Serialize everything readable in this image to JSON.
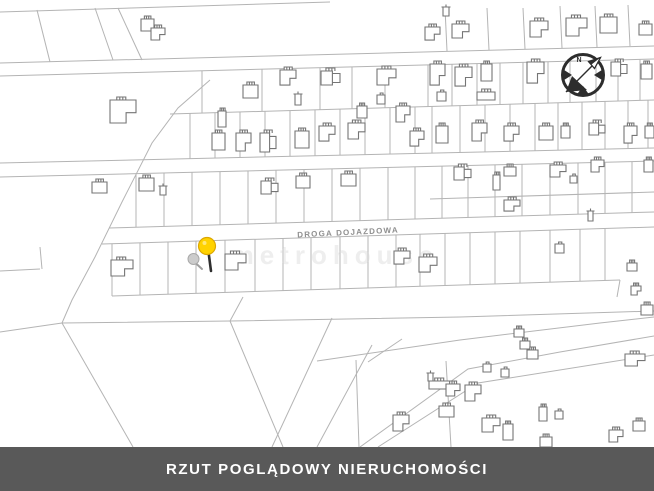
{
  "title_banner": {
    "text": "RZUT POGLĄDOWY NIERUCHOMOŚCI"
  },
  "road_label": {
    "text": "DROGA DOJAZDOWA"
  },
  "watermark": {
    "text": "metrohouse"
  },
  "compass": {
    "label": "N"
  },
  "colors": {
    "background": "#ffffff",
    "parcel_line": "#b4b4b4",
    "building_line": "#757575",
    "banner_bg": "#595959",
    "banner_text": "#ffffff",
    "pin_fill": "#ffd200",
    "pin_stroke": "#dca700",
    "pin_stem": "#2f2f2f",
    "gray_marker_fill": "#cccccc",
    "gray_marker_stroke": "#a9a9a9",
    "compass": "#2d2d2d",
    "road_label_color": "#8f8f8f",
    "watermark_color": "#d9d9d9"
  },
  "map": {
    "width": 654,
    "height": 447,
    "lines": {
      "topEdge": [
        [
          0,
          12
        ],
        [
          330,
          2
        ]
      ],
      "road1a": [
        [
          0,
          63
        ],
        [
          654,
          46
        ]
      ],
      "road1b": [
        [
          0,
          76
        ],
        [
          654,
          59
        ]
      ],
      "d1": [
        [
          170,
          114
        ],
        [
          654,
          100
        ]
      ],
      "road2a": [
        [
          0,
          163
        ],
        [
          654,
          148
        ]
      ],
      "road2b": [
        [
          0,
          177
        ],
        [
          654,
          161
        ]
      ],
      "d2": [
        [
          430,
          199
        ],
        [
          654,
          192
        ]
      ],
      "road3a": [
        [
          109,
          228
        ],
        [
          654,
          212
        ]
      ],
      "road3b": [
        [
          102,
          244
        ],
        [
          654,
          227
        ]
      ],
      "prBottom": [
        [
          112,
          296
        ],
        [
          620,
          280
        ]
      ],
      "prRight": [
        [
          617,
          297
        ],
        [
          620,
          280
        ]
      ],
      "longLine": [
        [
          62,
          323
        ],
        [
          230,
          321
        ],
        [
          460,
          317
        ],
        [
          654,
          311
        ]
      ],
      "bigDiag": [
        [
          210,
          80
        ],
        [
          178,
          108
        ],
        [
          152,
          143
        ],
        [
          122,
          202
        ],
        [
          95,
          257
        ],
        [
          72,
          300
        ],
        [
          62,
          323
        ]
      ],
      "branchLeft": [
        [
          0,
          332
        ],
        [
          62,
          323
        ]
      ],
      "branchDown": [
        [
          62,
          323
        ],
        [
          133,
          447
        ]
      ],
      "branchMid": [
        [
          230,
          321
        ],
        [
          283,
          447
        ]
      ],
      "branchUp": [
        [
          230,
          321
        ],
        [
          243,
          297
        ]
      ],
      "wedge": [
        [
          317,
          361
        ],
        [
          460,
          340
        ],
        [
          600,
          323
        ],
        [
          654,
          317
        ]
      ],
      "diagA": [
        [
          272,
          447
        ],
        [
          332,
          318
        ]
      ],
      "diagB": [
        [
          317,
          447
        ],
        [
          372,
          345
        ]
      ],
      "diagC": [
        [
          368,
          362
        ],
        [
          402,
          339
        ]
      ],
      "vertA": [
        [
          356,
          360
        ],
        [
          359,
          447
        ]
      ],
      "vertB": [
        [
          446,
          361
        ],
        [
          451,
          447
        ]
      ],
      "roadD1a": [
        [
          360,
          447
        ],
        [
          468,
          369
        ],
        [
          560,
          352
        ],
        [
          654,
          336
        ]
      ],
      "roadD1b": [
        [
          378,
          447
        ],
        [
          478,
          383
        ],
        [
          654,
          355
        ]
      ],
      "topSlant1": [
        [
          37,
          10
        ],
        [
          50,
          62
        ]
      ],
      "topSlant2": [
        [
          95,
          8
        ],
        [
          113,
          60
        ]
      ],
      "topSlant3": [
        [
          118,
          8
        ],
        [
          142,
          60
        ]
      ],
      "tv1": [
        [
          445,
          8
        ],
        [
          447,
          51
        ]
      ],
      "tv2": [
        [
          487,
          8
        ],
        [
          489,
          50
        ]
      ],
      "tv3": [
        [
          523,
          8
        ],
        [
          525,
          49
        ]
      ],
      "tv4": [
        [
          560,
          6
        ],
        [
          562,
          48
        ]
      ],
      "tv5": [
        [
          595,
          6
        ],
        [
          597,
          47
        ]
      ],
      "tv6": [
        [
          628,
          5
        ],
        [
          630,
          46
        ]
      ],
      "notchA": [
        [
          0,
          271
        ],
        [
          40,
          269
        ]
      ],
      "notchB": [
        [
          40,
          247
        ],
        [
          42,
          269
        ]
      ]
    },
    "dividers": [
      {
        "top": "road1b",
        "bottom": "d1",
        "xs": [
          202,
          262,
          320,
          352,
          385,
          428,
          452,
          477,
          500,
          523,
          548,
          570,
          596,
          618,
          640
        ]
      },
      {
        "top": "d1",
        "bottom": "road2a",
        "xs": [
          190,
          215,
          240,
          265,
          290,
          315,
          340,
          365,
          390,
          415,
          432,
          460,
          485,
          510,
          535,
          558,
          582,
          605,
          628,
          648
        ]
      },
      {
        "top": "road2b",
        "bottom": "road3a",
        "xs": [
          136,
          164,
          192,
          220,
          248,
          276,
          304,
          332,
          360,
          388,
          415,
          442,
          468,
          495,
          522,
          550,
          578,
          605,
          632
        ]
      },
      {
        "top": "road3b",
        "bottom": "prBottom",
        "xs": [
          112,
          140,
          168,
          196,
          225,
          255,
          283,
          311,
          340,
          368,
          396,
          420,
          445,
          470,
          495,
          520,
          550,
          580,
          605
        ]
      }
    ],
    "houses": [
      [
        141,
        19,
        13,
        12,
        0
      ],
      [
        151,
        28,
        14,
        12,
        1
      ],
      [
        110,
        100,
        26,
        23,
        1
      ],
      [
        425,
        27,
        15,
        13,
        1
      ],
      [
        452,
        24,
        17,
        14,
        1
      ],
      [
        443,
        7,
        6,
        9,
        4
      ],
      [
        530,
        21,
        18,
        16,
        1
      ],
      [
        566,
        18,
        21,
        18,
        1
      ],
      [
        600,
        17,
        17,
        16,
        0
      ],
      [
        639,
        24,
        13,
        11,
        0
      ],
      [
        295,
        94,
        6,
        11,
        4
      ],
      [
        430,
        64,
        15,
        21,
        1
      ],
      [
        455,
        67,
        17,
        19,
        1
      ],
      [
        481,
        64,
        11,
        17,
        0
      ],
      [
        527,
        62,
        17,
        21,
        1
      ],
      [
        611,
        62,
        16,
        14,
        2
      ],
      [
        641,
        64,
        11,
        15,
        0
      ],
      [
        437,
        92,
        9,
        9,
        3
      ],
      [
        477,
        92,
        18,
        8,
        0
      ],
      [
        243,
        85,
        15,
        13,
        0
      ],
      [
        280,
        70,
        16,
        15,
        1
      ],
      [
        321,
        71,
        19,
        14,
        2
      ],
      [
        377,
        69,
        19,
        16,
        1
      ],
      [
        212,
        133,
        13,
        17,
        0
      ],
      [
        236,
        133,
        15,
        18,
        1
      ],
      [
        260,
        133,
        16,
        19,
        2
      ],
      [
        295,
        131,
        14,
        17,
        0
      ],
      [
        319,
        126,
        16,
        15,
        1
      ],
      [
        348,
        123,
        17,
        16,
        1
      ],
      [
        357,
        106,
        10,
        12,
        0
      ],
      [
        396,
        106,
        14,
        16,
        1
      ],
      [
        377,
        95,
        8,
        9,
        3
      ],
      [
        410,
        131,
        14,
        15,
        1
      ],
      [
        218,
        111,
        8,
        16,
        0
      ],
      [
        436,
        126,
        12,
        17,
        0
      ],
      [
        472,
        123,
        15,
        18,
        1
      ],
      [
        504,
        126,
        15,
        15,
        1
      ],
      [
        539,
        126,
        14,
        14,
        0
      ],
      [
        561,
        126,
        9,
        12,
        0
      ],
      [
        589,
        123,
        16,
        12,
        2
      ],
      [
        624,
        126,
        13,
        17,
        1
      ],
      [
        645,
        126,
        9,
        12,
        0
      ],
      [
        92,
        182,
        15,
        11,
        0
      ],
      [
        139,
        178,
        15,
        13,
        0
      ],
      [
        160,
        186,
        6,
        9,
        4
      ],
      [
        261,
        181,
        17,
        13,
        2
      ],
      [
        296,
        176,
        14,
        12,
        0
      ],
      [
        341,
        174,
        15,
        12,
        0
      ],
      [
        454,
        167,
        17,
        13,
        2
      ],
      [
        493,
        175,
        7,
        15,
        0
      ],
      [
        504,
        167,
        12,
        9,
        0
      ],
      [
        550,
        165,
        16,
        12,
        1
      ],
      [
        570,
        176,
        7,
        7,
        3
      ],
      [
        591,
        160,
        13,
        12,
        1
      ],
      [
        504,
        200,
        16,
        11,
        1
      ],
      [
        588,
        211,
        5,
        10,
        4
      ],
      [
        644,
        160,
        9,
        12,
        0
      ],
      [
        111,
        260,
        22,
        16,
        1
      ],
      [
        225,
        254,
        21,
        16,
        1
      ],
      [
        394,
        251,
        16,
        13,
        1
      ],
      [
        419,
        257,
        18,
        15,
        1
      ],
      [
        555,
        244,
        9,
        9,
        3
      ],
      [
        627,
        263,
        10,
        8,
        0
      ],
      [
        631,
        286,
        10,
        9,
        1
      ],
      [
        641,
        305,
        12,
        10,
        0
      ],
      [
        428,
        373,
        5,
        8,
        4
      ],
      [
        429,
        381,
        22,
        8,
        0
      ],
      [
        446,
        384,
        14,
        12,
        1
      ],
      [
        465,
        385,
        16,
        16,
        1
      ],
      [
        439,
        406,
        15,
        11,
        0
      ],
      [
        393,
        415,
        16,
        16,
        1
      ],
      [
        482,
        418,
        18,
        14,
        1
      ],
      [
        503,
        424,
        10,
        16,
        0
      ],
      [
        483,
        364,
        8,
        8,
        3
      ],
      [
        501,
        369,
        8,
        8,
        3
      ],
      [
        539,
        407,
        8,
        14,
        0
      ],
      [
        555,
        411,
        8,
        8,
        3
      ],
      [
        514,
        329,
        10,
        8,
        0
      ],
      [
        520,
        341,
        10,
        8,
        0
      ],
      [
        527,
        350,
        11,
        9,
        0
      ],
      [
        625,
        354,
        20,
        12,
        1
      ],
      [
        609,
        430,
        14,
        12,
        1
      ],
      [
        633,
        421,
        12,
        10,
        0
      ],
      [
        540,
        437,
        12,
        10,
        0
      ]
    ],
    "pin": {
      "cx": 207,
      "cy": 246,
      "r": 8.5,
      "stem": [
        208.5,
        252,
        211,
        271
      ]
    },
    "gray_marker": {
      "cx": 193.5,
      "cy": 259,
      "r": 5.5,
      "stem": [
        195,
        262.5,
        202,
        269
      ]
    }
  }
}
